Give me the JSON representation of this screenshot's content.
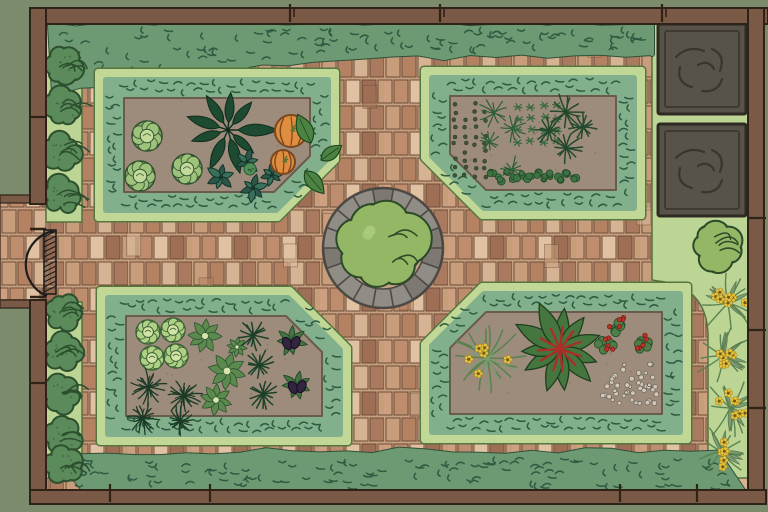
{
  "meta": {
    "description": "Illustrated top-down plan of a walled kitchen garden with four hedged vegetable beds, brick paths, central stone circle with topiary, compost bins, boundary shrubs and a west gate."
  },
  "palette": {
    "bg": "#7b8b6c",
    "wall": "#7a5a46",
    "wall_line": "#2f2216",
    "mortar": "#c6a07f",
    "brick_tones": [
      "#c79d7b",
      "#b58163",
      "#d6b493",
      "#aa7a5e",
      "#cda07f",
      "#bd8d6e",
      "#e0c2a2",
      "#9e6f55"
    ],
    "brick_line": "#6f4e3a",
    "light_band": "#bdd594",
    "band_line": "#55713f",
    "hedge_band": "#6d9a73",
    "hedge_mark": "#2d5c42",
    "bed_ring": "#c0d795",
    "bed_ring_line": "#57753f",
    "bed_hedge": "#82b08d",
    "soil": "#9d8c7c",
    "soil_line": "#6b5b4c",
    "soil_fleck": "#8b7b6a",
    "bin": "#57524a",
    "bin_line": "#2e2a23",
    "stone": "#908c86",
    "stone_dark": "#4e4943",
    "stone_inner": "#c6a385",
    "bush": "#94b766",
    "bush_hi": "#abc97c",
    "bush_line": "#2b4a27",
    "shrub": "#5b8a5b",
    "shrub_line": "#2c4f2e",
    "cabbage": [
      "#7ca25f",
      "#9fc27b",
      "#c3da9b",
      "#2f5130"
    ],
    "lettuce": [
      "#8fb46b",
      "#aed084",
      "#d2e3a6",
      "#3c6136"
    ],
    "kale": [
      "#2b574a",
      "#38705a",
      "#14332a"
    ],
    "dark_leaf": [
      "#1d4a31",
      "#0f2c1c"
    ],
    "pumpkin": [
      "#df8d3f",
      "#7a481e",
      "#4c8343",
      "#1f471f"
    ],
    "leafy": [
      "#5c8a4e",
      "#2c5230",
      "#d7e4ae"
    ],
    "fern": "#2e5e38",
    "spiky": "#23492e",
    "spiky_dark": "#1c4129",
    "dark_fern": "#1b3b26",
    "eggplant": [
      "#477344",
      "#204723",
      "#332440",
      "#150c20"
    ],
    "chard": [
      "#45763f",
      "#1e3e1d",
      "#a83028"
    ],
    "strawberry": [
      "#4e7f49",
      "#26512b",
      "#b23329"
    ],
    "flower": [
      "#5a8350",
      "#7d9c72",
      "#e7c43c",
      "#6e5a1a"
    ],
    "seed_dot": "#40503a",
    "grey_dot": [
      "#cfc8ba",
      "#5d564b"
    ],
    "row_leafy": [
      "#3d7342",
      "#1f4526"
    ],
    "broccoli": [
      "#4f8f5a",
      "#2c5a33"
    ]
  },
  "layout": {
    "canvas": [
      768,
      512
    ],
    "base_bricks": [
      46,
      24,
      702,
      471
    ],
    "exterior_path": [
      0,
      202,
      48,
      98
    ],
    "left_strip": [
      [
        46,
        24,
        36,
        198
      ],
      [
        46,
        302,
        36,
        176
      ]
    ],
    "right_strip_path": "M652 24 L748 24 L748 478 L708 478 L708 334 Q706 286 658 281 L652 280 Z",
    "walls": {
      "top": [
        30,
        8,
        738,
        16
      ],
      "left_upper": [
        30,
        8,
        16,
        196
      ],
      "left_lower": [
        30,
        300,
        16,
        196
      ],
      "right": [
        748,
        8,
        16,
        488
      ],
      "bottom": [
        30,
        490,
        736,
        14
      ]
    },
    "wall_stubs": [
      [
        0,
        195,
        32,
        8
      ],
      [
        0,
        300,
        32,
        8
      ]
    ],
    "hedge_top": {
      "x1": 50,
      "x2": 652,
      "y": 26,
      "thin": 28,
      "bulge": 38
    },
    "hedge_bottom": [
      54,
      454,
      690,
      38
    ],
    "posts": {
      "top": [
        290,
        440,
        662
      ],
      "bottom": [
        110,
        210,
        620,
        697
      ],
      "right": [
        218,
        330,
        408
      ],
      "left": [
        117,
        383
      ]
    }
  },
  "gate": {
    "leaf": [
      44,
      230,
      12,
      64
    ],
    "arc": "M54 231 A34 34 0 0 0 47 296",
    "hinges": [
      [
        30,
        46,
        229
      ],
      [
        30,
        46,
        297
      ]
    ]
  },
  "left_shrubs": {
    "x": 63,
    "r": 19,
    "ys": [
      66,
      108,
      152,
      196,
      312,
      352,
      394,
      436,
      466
    ]
  },
  "compost": {
    "bins": [
      [
        658,
        24,
        88,
        90
      ],
      [
        658,
        124,
        88,
        92
      ]
    ],
    "bush": {
      "cx": 716,
      "cy": 246,
      "r": 25
    }
  },
  "right_flowers": [
    {
      "cx": 728,
      "cy": 303,
      "s": 26
    },
    {
      "cx": 723,
      "cy": 356,
      "s": 27
    },
    {
      "cx": 730,
      "cy": 408,
      "s": 26
    },
    {
      "cx": 722,
      "cy": 452,
      "s": 24
    }
  ],
  "center_feature": {
    "cx": 383,
    "cy": 248,
    "r_outer": 60,
    "r_inner": 41,
    "segments": 18,
    "bush_r": 46
  },
  "beds": [
    {
      "name": "bed-top-left",
      "outer": [
        98,
        72,
        238,
        146
      ],
      "chamfer": "br",
      "cut": 58,
      "plants": [
        {
          "t": "cabbage",
          "x": 147,
          "y": 136,
          "s": 15
        },
        {
          "t": "cabbage",
          "x": 140,
          "y": 176,
          "s": 15
        },
        {
          "t": "cabbage",
          "x": 187,
          "y": 169,
          "s": 15
        },
        {
          "t": "rhubarbDark",
          "x": 228,
          "y": 130,
          "s": 34
        },
        {
          "t": "kale",
          "x": 221,
          "y": 177,
          "s": 14
        },
        {
          "t": "kale",
          "x": 247,
          "y": 162,
          "s": 12
        },
        {
          "t": "kale",
          "x": 253,
          "y": 188,
          "s": 13
        },
        {
          "t": "kale",
          "x": 272,
          "y": 175,
          "s": 12
        },
        {
          "t": "broccoli",
          "x": 250,
          "y": 169,
          "s": 6
        },
        {
          "t": "pumpkin",
          "x": 291,
          "y": 131,
          "s": 16
        },
        {
          "t": "pumpkin",
          "x": 283,
          "y": 162,
          "s": 12
        },
        {
          "t": "pumpkinLeaf",
          "x": 311,
          "y": 143,
          "s": 15,
          "rot": -25
        },
        {
          "t": "pumpkinLeaf",
          "x": 305,
          "y": 171,
          "s": 14,
          "rot": 140
        },
        {
          "t": "pumpkinLeaf",
          "x": 321,
          "y": 160,
          "s": 12,
          "rot": 55
        }
      ]
    },
    {
      "name": "bed-top-right",
      "outer": [
        424,
        70,
        218,
        146
      ],
      "chamfer": "bl",
      "cut": 58,
      "plants": [
        {
          "t": "seedGrid",
          "x": 455,
          "y": 104,
          "cols": 4,
          "rows": 10,
          "dx": 10,
          "dy": 8
        },
        {
          "t": "fernStar",
          "x": 494,
          "y": 113,
          "s": 14
        },
        {
          "t": "fernStar",
          "x": 513,
          "y": 128,
          "s": 12
        },
        {
          "t": "fernStar",
          "x": 489,
          "y": 142,
          "s": 11
        },
        {
          "t": "fernStar",
          "x": 512,
          "y": 170,
          "s": 12
        },
        {
          "t": "crossGrid",
          "x": 518,
          "y": 106,
          "cols": 4,
          "rows": 4,
          "dx": 13,
          "dy": 12
        },
        {
          "t": "spiky",
          "x": 566,
          "y": 112,
          "s": 16
        },
        {
          "t": "spiky",
          "x": 549,
          "y": 131,
          "s": 12
        },
        {
          "t": "spiky",
          "x": 566,
          "y": 148,
          "s": 14
        },
        {
          "t": "spiky",
          "x": 583,
          "y": 127,
          "s": 12
        },
        {
          "t": "leafyRow",
          "x": 492,
          "y": 176,
          "n": 12,
          "dx": 7.5
        }
      ]
    },
    {
      "name": "bed-bottom-left",
      "outer": [
        100,
        290,
        248,
        152
      ],
      "chamfer": "tr",
      "cut": 58,
      "plants": [
        {
          "t": "lettuce",
          "x": 148,
          "y": 332,
          "s": 12
        },
        {
          "t": "lettuce",
          "x": 173,
          "y": 330,
          "s": 12
        },
        {
          "t": "lettuce",
          "x": 152,
          "y": 358,
          "s": 12
        },
        {
          "t": "lettuce",
          "x": 176,
          "y": 356,
          "s": 12
        },
        {
          "t": "leafyRadial",
          "x": 205,
          "y": 336,
          "s": 17
        },
        {
          "t": "leafyRadial",
          "x": 227,
          "y": 371,
          "s": 19
        },
        {
          "t": "leafyRadial",
          "x": 216,
          "y": 400,
          "s": 16
        },
        {
          "t": "leafyRadial",
          "x": 237,
          "y": 347,
          "s": 10
        },
        {
          "t": "spikyDark",
          "x": 253,
          "y": 335,
          "s": 14
        },
        {
          "t": "spikyDark",
          "x": 259,
          "y": 365,
          "s": 14
        },
        {
          "t": "spikyDark",
          "x": 263,
          "y": 394,
          "s": 13
        },
        {
          "t": "eggplant",
          "x": 291,
          "y": 341,
          "s": 16
        },
        {
          "t": "eggplant",
          "x": 297,
          "y": 385,
          "s": 16
        },
        {
          "t": "darkFern",
          "x": 148,
          "y": 387,
          "s": 16
        },
        {
          "t": "darkFern",
          "x": 184,
          "y": 396,
          "s": 16
        },
        {
          "t": "darkFern",
          "x": 143,
          "y": 418,
          "s": 14
        },
        {
          "t": "darkFern",
          "x": 180,
          "y": 421,
          "s": 13
        }
      ]
    },
    {
      "name": "bed-bottom-right",
      "outer": [
        424,
        286,
        264,
        154
      ],
      "chamfer": "tl",
      "cut": 58,
      "plants": [
        {
          "t": "flowerGrass",
          "x": 487,
          "y": 358,
          "s": 34
        },
        {
          "t": "chard",
          "x": 560,
          "y": 349,
          "s": 44
        },
        {
          "t": "strawberry",
          "x": 619,
          "y": 326,
          "s": 14
        },
        {
          "t": "strawberry",
          "x": 606,
          "y": 346,
          "s": 13
        },
        {
          "t": "strawberry",
          "x": 641,
          "y": 343,
          "s": 13
        },
        {
          "t": "dotScatter",
          "x": 592,
          "y": 364,
          "w": 66,
          "h": 40,
          "n": 46
        }
      ]
    }
  ]
}
